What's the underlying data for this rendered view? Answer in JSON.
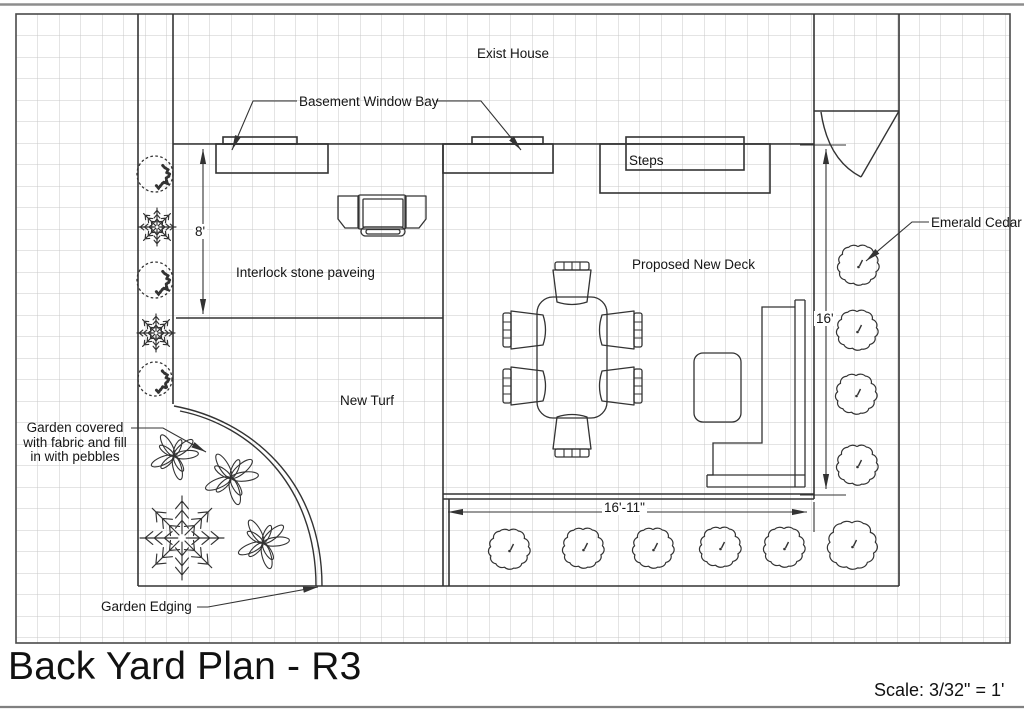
{
  "title_block": {
    "title": "Back Yard Plan - R3",
    "scale_label": "Scale: 3/32\" = 1'"
  },
  "labels": {
    "exist_house": "Exist House",
    "basement_window_bay": "Basement Window Bay",
    "steps": "Steps",
    "interlock_paving": "Interlock stone paveing",
    "proposed_deck": "Proposed New Deck",
    "emerald_cedar": "Emerald Cedar",
    "new_turf": "New Turf",
    "garden_note_line1": "Garden covered",
    "garden_note_line2": "with fabric and fill",
    "garden_note_line3": "in with pebbles",
    "garden_edging": "Garden Edging"
  },
  "dimensions": {
    "paving_depth": "8'",
    "deck_depth": "16'",
    "deck_width": "16'-11\""
  },
  "colors": {
    "line": "#333333",
    "grid": "#c9c9c9",
    "text": "#151515",
    "sheet_edge": "#8d8d8d"
  },
  "plants": [
    {
      "type": "shrub",
      "x": 155,
      "y": 174,
      "r": 18
    },
    {
      "type": "conifer",
      "x": 157,
      "y": 227,
      "r": 19
    },
    {
      "type": "shrub",
      "x": 155,
      "y": 280,
      "r": 18
    },
    {
      "type": "conifer",
      "x": 156,
      "y": 333,
      "r": 19
    },
    {
      "type": "shrub",
      "x": 155,
      "y": 379,
      "r": 17
    },
    {
      "type": "flower",
      "x": 174,
      "y": 456,
      "r": 24
    },
    {
      "type": "flower",
      "x": 231,
      "y": 478,
      "r": 27
    },
    {
      "type": "conifer",
      "x": 182,
      "y": 538,
      "r": 42
    },
    {
      "type": "flower",
      "x": 263,
      "y": 543,
      "r": 26
    },
    {
      "type": "cedar",
      "x": 858,
      "y": 265,
      "r": 20
    },
    {
      "type": "cedar",
      "x": 857,
      "y": 330,
      "r": 20
    },
    {
      "type": "cedar",
      "x": 856,
      "y": 394,
      "r": 20
    },
    {
      "type": "cedar",
      "x": 857,
      "y": 465,
      "r": 20
    },
    {
      "type": "cedar",
      "x": 509,
      "y": 549,
      "r": 20
    },
    {
      "type": "cedar",
      "x": 583,
      "y": 548,
      "r": 20
    },
    {
      "type": "cedar",
      "x": 653,
      "y": 548,
      "r": 20
    },
    {
      "type": "cedar",
      "x": 720,
      "y": 547,
      "r": 20
    },
    {
      "type": "cedar",
      "x": 784,
      "y": 547,
      "r": 20
    },
    {
      "type": "cedar",
      "x": 852,
      "y": 545,
      "r": 24
    }
  ]
}
